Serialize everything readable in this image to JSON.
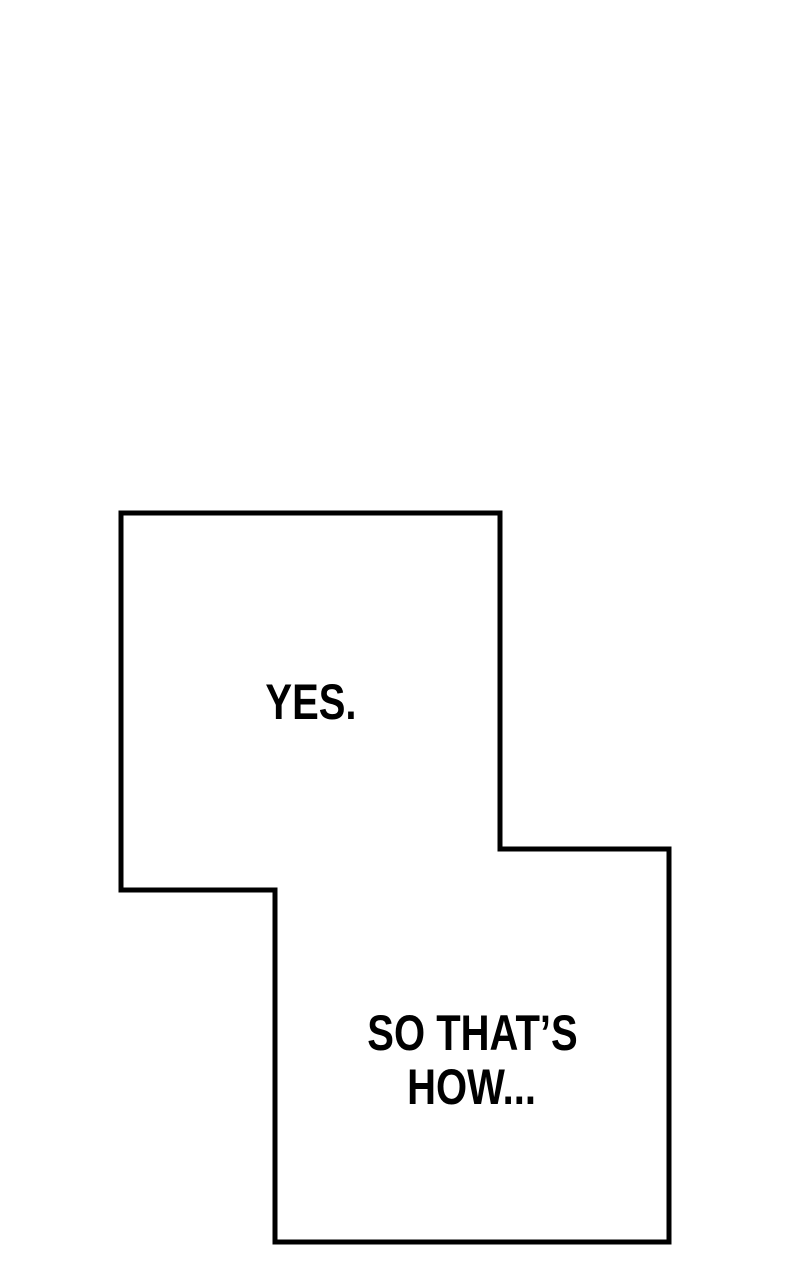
{
  "page": {
    "background": "#ffffff",
    "outline_color": "#000000",
    "text_color": "#000000"
  },
  "panels": [
    {
      "name": "panel-yes",
      "text": "YES."
    },
    {
      "name": "panel-so-thats-how",
      "lines": [
        "SO THAT’S",
        "HOW..."
      ]
    }
  ]
}
